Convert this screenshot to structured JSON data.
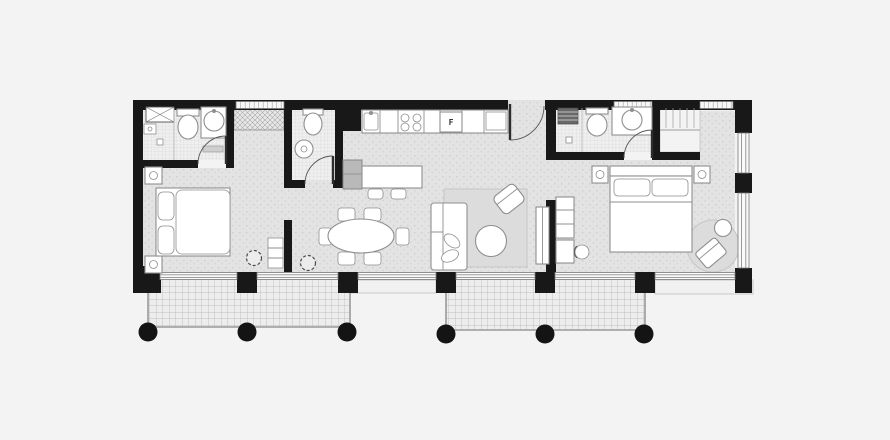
{
  "scene": {
    "type": "architectural-floor-plan",
    "view": "top-down-2d",
    "apartment": "two-bedroom-with-two-balconies"
  },
  "colors": {
    "background": "#f3f3f4",
    "wall": "#181818",
    "floor_base": "#e3e3e3",
    "bathroom_floor": "#eeeeee",
    "furniture_fill": "#ffffff",
    "furniture_stroke": "#8f8f8f",
    "rug": "#dcdcdc",
    "balcony_line": "#9a9a9a",
    "window_line": "#8f8f8f",
    "column": "#141414"
  },
  "labels": {
    "fridge": "F"
  },
  "rooms": [
    {
      "id": "bathroom-1",
      "features": [
        "shaft",
        "shower",
        "toilet",
        "washbasin",
        "door"
      ]
    },
    {
      "id": "bedroom-1",
      "features": [
        "double-bed",
        "nightstand",
        "nightstand",
        "built-in-closet",
        "shelf",
        "plant"
      ]
    },
    {
      "id": "wc",
      "features": [
        "toilet",
        "pedestal-sink",
        "door"
      ]
    },
    {
      "id": "kitchen",
      "features": [
        "counter",
        "sink",
        "cooktop-4-burner",
        "fridge",
        "tall-cabinet",
        "island",
        "stool",
        "stool"
      ]
    },
    {
      "id": "living-dining",
      "features": [
        "oval-dining-table",
        "six-chairs",
        "sofa",
        "coffee-table",
        "armchair",
        "area-rug",
        "tv-sideboard",
        "plant"
      ]
    },
    {
      "id": "entry",
      "features": [
        "entrance-door"
      ]
    },
    {
      "id": "bathroom-2",
      "features": [
        "radiator",
        "shower",
        "toilet",
        "washbasin",
        "door",
        "window"
      ]
    },
    {
      "id": "bedroom-2",
      "features": [
        "double-bed",
        "nightstand",
        "nightstand",
        "wardrobe",
        "desk",
        "desk-chair",
        "round-rug",
        "lounge-chair",
        "side-table"
      ]
    },
    {
      "id": "balcony-left",
      "columns_round": 3
    },
    {
      "id": "balcony-right",
      "columns_round": 3
    }
  ],
  "structure": {
    "square_wall_columns": 7,
    "round_balcony_columns": 6,
    "window_bands": [
      "top-left-closet",
      "above-bathroom-2-sink",
      "bedroom-2-top",
      "full-south-facade",
      "east-facade"
    ]
  }
}
